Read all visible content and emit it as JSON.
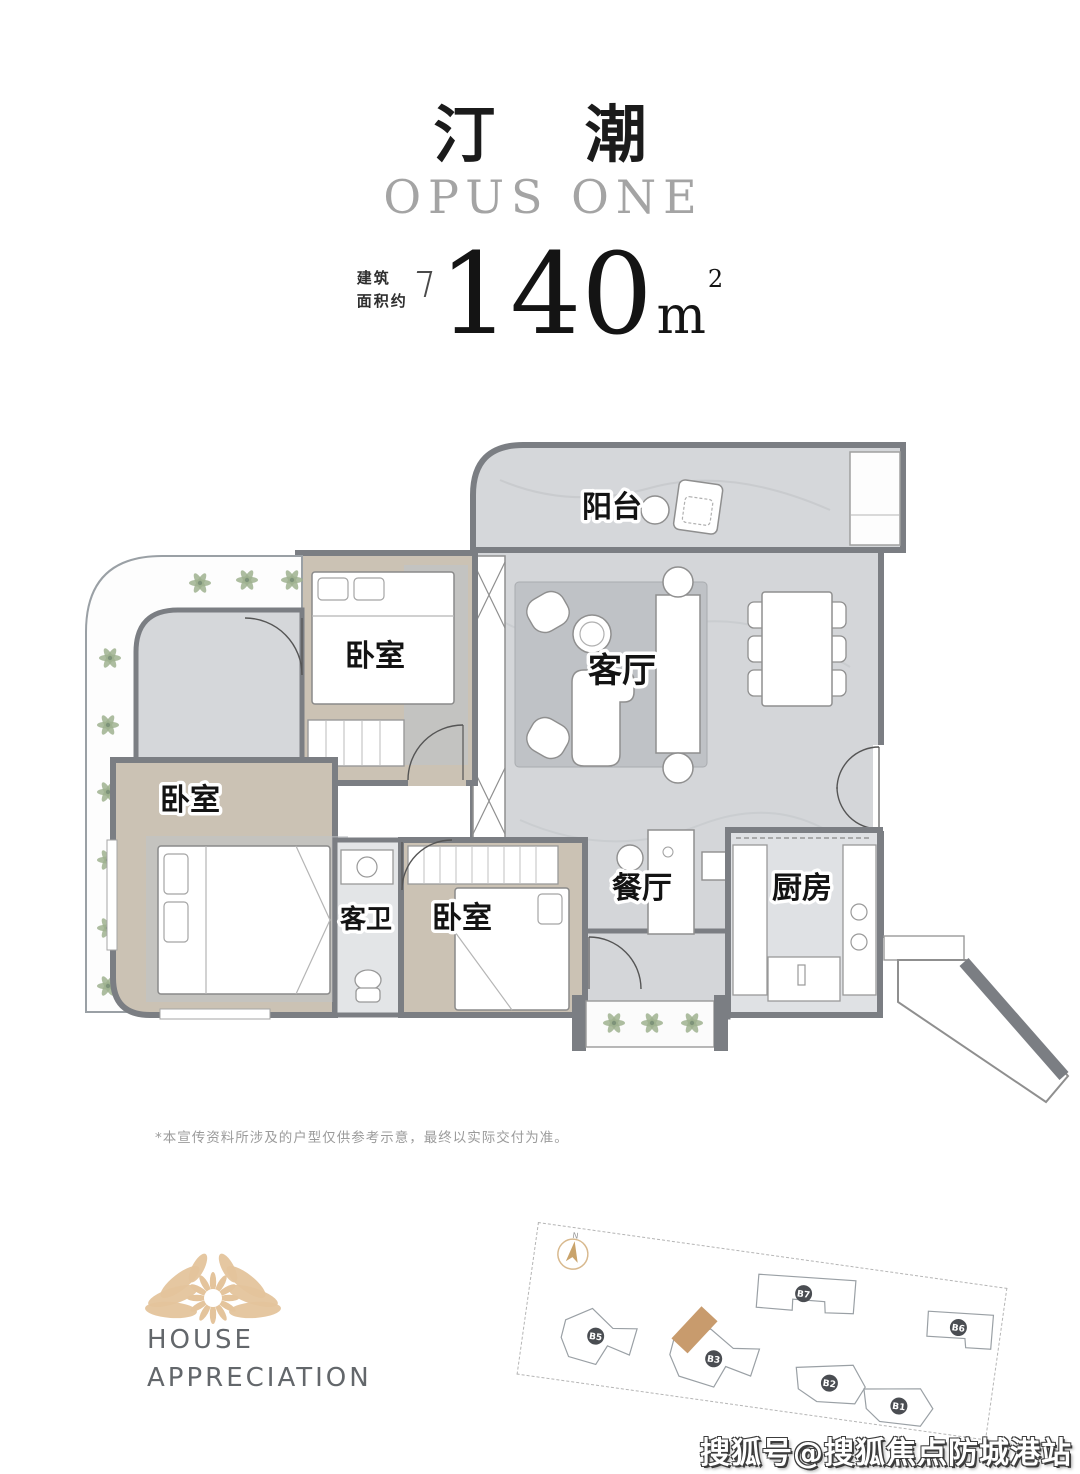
{
  "header": {
    "title": "汀 潮",
    "subtitle": "OPUS ONE",
    "area_prefix_line1": "建筑",
    "area_prefix_line2": "面积约",
    "area_number": "140",
    "area_unit": "m",
    "area_exponent": "2"
  },
  "plan": {
    "rooms": [
      {
        "id": "balcony",
        "label": "阳台"
      },
      {
        "id": "bedroom-top",
        "label": "卧室"
      },
      {
        "id": "living-room",
        "label": "客厅"
      },
      {
        "id": "bedroom-left",
        "label": "卧室"
      },
      {
        "id": "guest-bath",
        "label": "客卫"
      },
      {
        "id": "bedroom-mid",
        "label": "卧室"
      },
      {
        "id": "dining-room",
        "label": "餐厅"
      },
      {
        "id": "kitchen",
        "label": "厨房"
      }
    ]
  },
  "disclaimer": "*本宣传资料所涉及的户型仅供参考示意，最终以实际交付为准。",
  "brand": {
    "line1": "HOUSE",
    "line2": "APPRECIATION"
  },
  "sitemap": {
    "north": "N",
    "buildings": [
      "B7",
      "B6",
      "B5",
      "B3",
      "B2",
      "B1"
    ]
  },
  "watermark": "搜狐号@搜狐焦点防城港站",
  "colors": {
    "wall": "#7b7e83",
    "marble_floor": "#d5d7da",
    "wood_floor": "#cbc2b4",
    "brand_gold": "#e4c49c",
    "site_highlight": "#c89b6d",
    "plant_green": "#9fb28f"
  }
}
